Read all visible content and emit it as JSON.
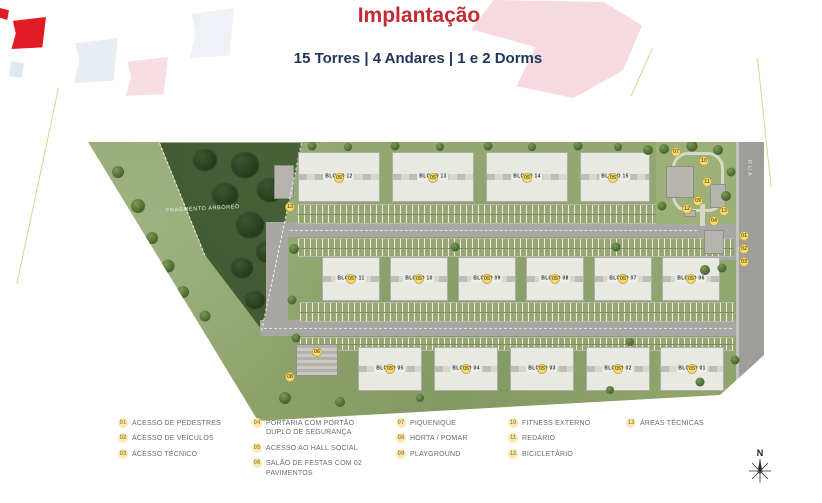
{
  "header": {
    "title": "Implantação",
    "subtitle": "15 Torres | 4 Andares | 1 e 2 Dorms"
  },
  "site": {
    "forest_label": "FRAGMENTO ARBÓREO",
    "street_label": "RUA",
    "compass_label": "N",
    "buildings": [
      {
        "label": "BLOCO 12",
        "x": 298,
        "y": 152,
        "w": 82,
        "h": 50
      },
      {
        "label": "BLOCO 13",
        "x": 392,
        "y": 152,
        "w": 82,
        "h": 50
      },
      {
        "label": "BLOCO 14",
        "x": 486,
        "y": 152,
        "w": 82,
        "h": 50
      },
      {
        "label": "BLOCO 15",
        "x": 580,
        "y": 152,
        "w": 70,
        "h": 50
      },
      {
        "label": "BLOCO 11",
        "x": 322,
        "y": 257,
        "w": 58,
        "h": 44
      },
      {
        "label": "BLOCO 10",
        "x": 390,
        "y": 257,
        "w": 58,
        "h": 44
      },
      {
        "label": "BLOCO 09",
        "x": 458,
        "y": 257,
        "w": 58,
        "h": 44
      },
      {
        "label": "BLOCO 08",
        "x": 526,
        "y": 257,
        "w": 58,
        "h": 44
      },
      {
        "label": "BLOCO 07",
        "x": 594,
        "y": 257,
        "w": 58,
        "h": 44
      },
      {
        "label": "BLOCO 06",
        "x": 662,
        "y": 257,
        "w": 58,
        "h": 44
      },
      {
        "label": "BLOCO 05",
        "x": 358,
        "y": 347,
        "w": 64,
        "h": 44
      },
      {
        "label": "BLOCO 04",
        "x": 434,
        "y": 347,
        "w": 64,
        "h": 44
      },
      {
        "label": "BLOCO 03",
        "x": 510,
        "y": 347,
        "w": 64,
        "h": 44
      },
      {
        "label": "BLOCO 02",
        "x": 586,
        "y": 347,
        "w": 64,
        "h": 44
      },
      {
        "label": "BLOCO 01",
        "x": 660,
        "y": 347,
        "w": 64,
        "h": 44
      }
    ],
    "markers": [
      {
        "n": "05",
        "x": 339,
        "y": 178
      },
      {
        "n": "05",
        "x": 433,
        "y": 178
      },
      {
        "n": "05",
        "x": 527,
        "y": 178
      },
      {
        "n": "05",
        "x": 613,
        "y": 178
      },
      {
        "n": "05",
        "x": 351,
        "y": 279
      },
      {
        "n": "05",
        "x": 419,
        "y": 279
      },
      {
        "n": "05",
        "x": 487,
        "y": 279
      },
      {
        "n": "05",
        "x": 555,
        "y": 279
      },
      {
        "n": "05",
        "x": 623,
        "y": 279
      },
      {
        "n": "05",
        "x": 691,
        "y": 279
      },
      {
        "n": "05",
        "x": 390,
        "y": 369
      },
      {
        "n": "05",
        "x": 466,
        "y": 369
      },
      {
        "n": "05",
        "x": 542,
        "y": 369
      },
      {
        "n": "05",
        "x": 618,
        "y": 369
      },
      {
        "n": "05",
        "x": 692,
        "y": 369
      },
      {
        "n": "04",
        "x": 714,
        "y": 221
      },
      {
        "n": "01",
        "x": 744,
        "y": 236
      },
      {
        "n": "02",
        "x": 744,
        "y": 249
      },
      {
        "n": "03",
        "x": 744,
        "y": 262
      },
      {
        "n": "13",
        "x": 290,
        "y": 207
      },
      {
        "n": "13",
        "x": 724,
        "y": 211
      },
      {
        "n": "07",
        "x": 676,
        "y": 152
      },
      {
        "n": "10",
        "x": 704,
        "y": 161
      },
      {
        "n": "11",
        "x": 707,
        "y": 182
      },
      {
        "n": "09",
        "x": 698,
        "y": 201
      },
      {
        "n": "12",
        "x": 687,
        "y": 209
      },
      {
        "n": "06",
        "x": 317,
        "y": 352
      },
      {
        "n": "08",
        "x": 290,
        "y": 377
      }
    ]
  },
  "legend": {
    "columns": [
      {
        "x": 118,
        "items": [
          {
            "num": "01",
            "label": "ACESSO DE PEDESTRES"
          },
          {
            "num": "02",
            "label": "ACESSO DE VEÍCULOS"
          },
          {
            "num": "03",
            "label": "ACESSO TÉCNICO"
          }
        ]
      },
      {
        "x": 252,
        "items": [
          {
            "num": "04",
            "label": "PORTARIA COM PORTÃO DUPLO DE SEGURANÇA"
          },
          {
            "num": "05",
            "label": "ACESSO AO HALL SOCIAL"
          },
          {
            "num": "06",
            "label": "SALÃO DE FESTAS COM 02 PAVIMENTOS"
          }
        ]
      },
      {
        "x": 396,
        "items": [
          {
            "num": "07",
            "label": "PIQUENIQUE"
          },
          {
            "num": "08",
            "label": "HORTA / POMAR"
          },
          {
            "num": "09",
            "label": "PLAYGROUND"
          }
        ]
      },
      {
        "x": 508,
        "items": [
          {
            "num": "10",
            "label": "FITNESS EXTERNO"
          },
          {
            "num": "11",
            "label": "REDÁRIO"
          },
          {
            "num": "12",
            "label": "BICICLETÁRIO"
          }
        ]
      },
      {
        "x": 626,
        "items": [
          {
            "num": "13",
            "label": "ÁREAS TÉCNICAS"
          }
        ]
      }
    ]
  },
  "colors": {
    "title_red": "#c42a33",
    "subtitle_navy": "#22365c",
    "marker_yellow": "#f2dd7c",
    "grass_green": "#93a873",
    "forest_green": "#3c5530",
    "road_gray": "#a7a8a4"
  }
}
